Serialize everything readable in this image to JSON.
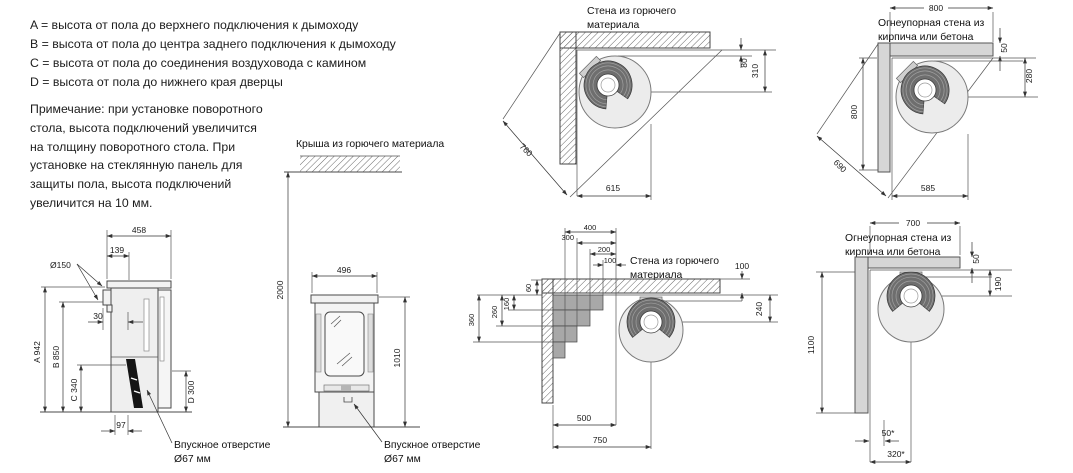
{
  "legend": {
    "lines": [
      "A = высота от пола до верхнего подключения к дымоходу",
      "B = высота от пола до центра заднего подключения к дымоходу",
      "C = высота от пола до соединения воздуховода с камином",
      "D = высота от пола до нижнего края дверцы"
    ]
  },
  "note": {
    "lines": [
      "Примечание: при установке поворотного",
      "стола, высота подключений увеличится",
      "на толщину поворотного стола.  При",
      "установке на стеклянную панель для",
      "защиты пола, высота подключений",
      "увеличится на 10 мм."
    ]
  },
  "side_view": {
    "dim_width_top": "458",
    "dim_flue_offset": "139",
    "flue_diameter": "Ø150",
    "dim_rear_gap": "30",
    "dim_a": "A 942",
    "dim_b": "B 850",
    "dim_c": "C 340",
    "dim_d": "D 300",
    "dim_inlet_offset": "97",
    "inlet_label_line1": "Впускное отверстие",
    "inlet_label_line2": "Ø67 мм"
  },
  "front_view": {
    "roof_label": "Крыша из горючего материала",
    "dim_ceiling": "2000",
    "dim_width": "496",
    "dim_height": "1010",
    "inlet_label_line1": "Впускное отверстие",
    "inlet_label_line2": "Ø67 мм"
  },
  "corner_combustible": {
    "title_line1": "Стена из горючего",
    "title_line2": "материала",
    "dim_back_gap": "80",
    "dim_center": "310",
    "dim_diagonal": "760",
    "dim_front": "615"
  },
  "corner_firewall_a": {
    "title_line1": "Огнеупорная стена из",
    "title_line2": "кирпича или бетона",
    "dim_wall_top": "800",
    "dim_thickness": "50",
    "dim_center": "280",
    "dim_wall_left": "800",
    "dim_diagonal": "690",
    "dim_front": "585"
  },
  "stepped_shield": {
    "title_line1": "Стена из горючего",
    "title_line2": "материала",
    "dim_step_400": "400",
    "dim_step_300": "300",
    "dim_step_200": "200",
    "dim_step_100": "100",
    "dim_wall_thickness": "100",
    "dim_center": "240",
    "dim_shield_60": "60",
    "dim_shield_160": "160",
    "dim_shield_260": "260",
    "dim_shield_360": "360",
    "dim_side": "500",
    "dim_center_bottom": "750"
  },
  "corner_firewall_b": {
    "title_line1": "Огнеупорная стена из",
    "title_line2": "кирпича или бетона",
    "dim_wall_top": "700",
    "dim_thickness": "50",
    "dim_back_gap": "190",
    "dim_wall_left": "1100",
    "dim_50_star": "50*",
    "dim_320_star": "320*"
  }
}
